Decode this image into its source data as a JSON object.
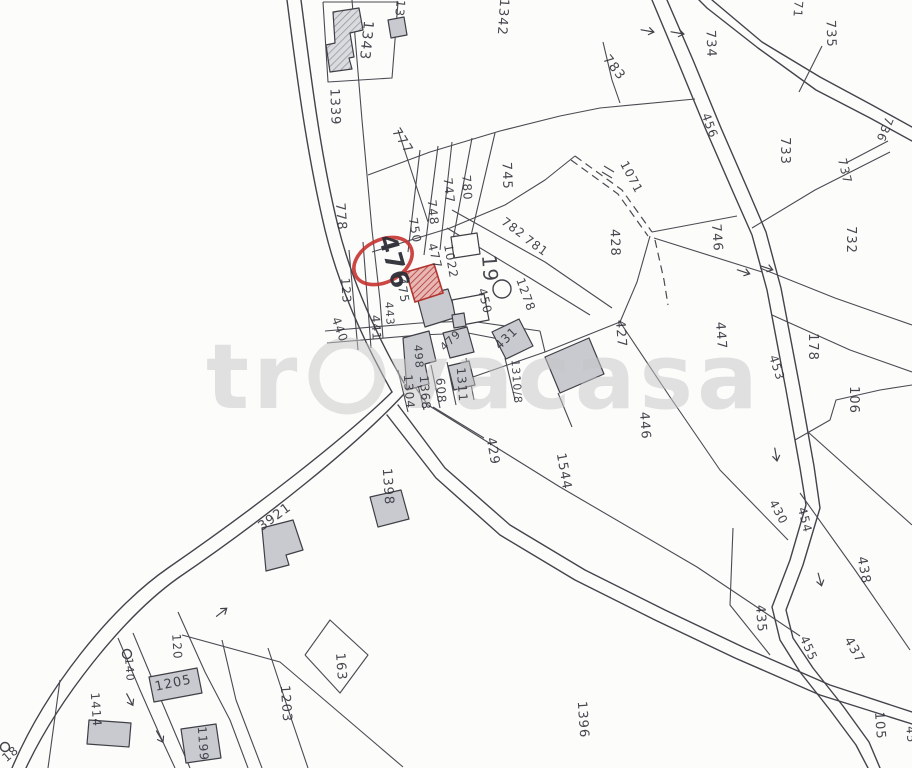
{
  "map": {
    "watermark": {
      "prefix": "tr",
      "suffix": "vacasa",
      "full": "trovacasa",
      "color": "#c6c6c6"
    },
    "highlight": {
      "parcel": "476",
      "ellipse_color": "#c63230",
      "building_fill": "#c0504d"
    },
    "colors": {
      "line": "#43434b",
      "building_fill": "#c8cad0",
      "background": "#fcfcfb",
      "label": "#2e2f37",
      "highlight_red": "#c63230"
    },
    "labels": [
      {
        "text": "1343",
        "x": 362,
        "y": 40,
        "rot": 96,
        "size": 14
      },
      {
        "text": "13",
        "x": 396,
        "y": 8,
        "rot": 96,
        "size": 12
      },
      {
        "text": "1342",
        "x": 499,
        "y": 17,
        "rot": 94,
        "size": 13
      },
      {
        "text": "1339",
        "x": 331,
        "y": 107,
        "rot": 88,
        "size": 13
      },
      {
        "text": "777",
        "x": 399,
        "y": 143,
        "rot": 58,
        "size": 13
      },
      {
        "text": "783",
        "x": 611,
        "y": 70,
        "rot": 52,
        "size": 13
      },
      {
        "text": "71",
        "x": 794,
        "y": 9,
        "rot": 94,
        "size": 12
      },
      {
        "text": "734",
        "x": 707,
        "y": 44,
        "rot": 88,
        "size": 13
      },
      {
        "text": "735",
        "x": 827,
        "y": 34,
        "rot": 88,
        "size": 13
      },
      {
        "text": "736",
        "x": 881,
        "y": 128,
        "rot": 112,
        "size": 12
      },
      {
        "text": "733",
        "x": 781,
        "y": 151,
        "rot": 90,
        "size": 13
      },
      {
        "text": "737",
        "x": 841,
        "y": 172,
        "rot": 76,
        "size": 12
      },
      {
        "text": "732",
        "x": 847,
        "y": 240,
        "rot": 90,
        "size": 13
      },
      {
        "text": "456",
        "x": 706,
        "y": 127,
        "rot": 70,
        "size": 12
      },
      {
        "text": "1071",
        "x": 628,
        "y": 179,
        "rot": 62,
        "size": 12
      },
      {
        "text": "428",
        "x": 611,
        "y": 243,
        "rot": 88,
        "size": 13
      },
      {
        "text": "746",
        "x": 713,
        "y": 238,
        "rot": 86,
        "size": 13
      },
      {
        "text": "745",
        "x": 503,
        "y": 176,
        "rot": 88,
        "size": 13
      },
      {
        "text": "780",
        "x": 463,
        "y": 188,
        "rot": 86,
        "size": 12
      },
      {
        "text": "747",
        "x": 445,
        "y": 191,
        "rot": 84,
        "size": 12
      },
      {
        "text": "748",
        "x": 429,
        "y": 213,
        "rot": 84,
        "size": 12
      },
      {
        "text": "750",
        "x": 411,
        "y": 231,
        "rot": 80,
        "size": 12
      },
      {
        "text": "778",
        "x": 337,
        "y": 217,
        "rot": 86,
        "size": 13
      },
      {
        "text": "782",
        "x": 511,
        "y": 231,
        "rot": 36,
        "size": 12
      },
      {
        "text": "781",
        "x": 534,
        "y": 249,
        "rot": 36,
        "size": 12
      },
      {
        "text": "123",
        "x": 342,
        "y": 291,
        "rot": 86,
        "size": 12
      },
      {
        "text": "440",
        "x": 336,
        "y": 331,
        "rot": 70,
        "size": 12
      },
      {
        "text": "441",
        "x": 372,
        "y": 328,
        "rot": 86,
        "size": 12
      },
      {
        "text": "443",
        "x": 386,
        "y": 314,
        "rot": 86,
        "size": 11
      },
      {
        "text": "475",
        "x": 399,
        "y": 291,
        "rot": 80,
        "size": 12
      },
      {
        "text": "477",
        "x": 431,
        "y": 257,
        "rot": 76,
        "size": 12
      },
      {
        "text": "1022",
        "x": 447,
        "y": 262,
        "rot": 80,
        "size": 12
      },
      {
        "text": "476",
        "x": 386,
        "y": 264,
        "rot": 74,
        "size": 25,
        "emph": true
      },
      {
        "text": "19",
        "x": 483,
        "y": 269,
        "rot": 86,
        "size": 20
      },
      {
        "text": "450",
        "x": 481,
        "y": 302,
        "rot": 76,
        "size": 12
      },
      {
        "text": "1278",
        "x": 522,
        "y": 296,
        "rot": 70,
        "size": 12
      },
      {
        "text": "431",
        "x": 509,
        "y": 341,
        "rot": -44,
        "size": 12
      },
      {
        "text": "479",
        "x": 453,
        "y": 343,
        "rot": -44,
        "size": 11
      },
      {
        "text": "498",
        "x": 415,
        "y": 357,
        "rot": 86,
        "size": 11
      },
      {
        "text": "1310/8",
        "x": 513,
        "y": 382,
        "rot": 86,
        "size": 11
      },
      {
        "text": "1304",
        "x": 405,
        "y": 392,
        "rot": 86,
        "size": 12
      },
      {
        "text": "1368",
        "x": 421,
        "y": 393,
        "rot": 86,
        "size": 12
      },
      {
        "text": "608",
        "x": 437,
        "y": 391,
        "rot": 86,
        "size": 12
      },
      {
        "text": "1311",
        "x": 458,
        "y": 385,
        "rot": 86,
        "size": 12
      },
      {
        "text": "429",
        "x": 489,
        "y": 452,
        "rot": 80,
        "size": 13
      },
      {
        "text": "1544",
        "x": 560,
        "y": 472,
        "rot": 80,
        "size": 13
      },
      {
        "text": "446",
        "x": 641,
        "y": 426,
        "rot": 86,
        "size": 13
      },
      {
        "text": "427",
        "x": 617,
        "y": 334,
        "rot": 86,
        "size": 13
      },
      {
        "text": "447",
        "x": 717,
        "y": 336,
        "rot": 86,
        "size": 13
      },
      {
        "text": "453",
        "x": 773,
        "y": 369,
        "rot": 72,
        "size": 12
      },
      {
        "text": "178",
        "x": 809,
        "y": 347,
        "rot": 90,
        "size": 13
      },
      {
        "text": "106",
        "x": 850,
        "y": 400,
        "rot": 90,
        "size": 13
      },
      {
        "text": "430",
        "x": 775,
        "y": 514,
        "rot": 62,
        "size": 12
      },
      {
        "text": "454",
        "x": 801,
        "y": 521,
        "rot": 76,
        "size": 12
      },
      {
        "text": "438",
        "x": 860,
        "y": 571,
        "rot": 80,
        "size": 13
      },
      {
        "text": "435",
        "x": 757,
        "y": 619,
        "rot": 86,
        "size": 13
      },
      {
        "text": "455",
        "x": 805,
        "y": 650,
        "rot": 66,
        "size": 12
      },
      {
        "text": "437",
        "x": 851,
        "y": 652,
        "rot": 60,
        "size": 13
      },
      {
        "text": "105",
        "x": 876,
        "y": 726,
        "rot": 86,
        "size": 13
      },
      {
        "text": "45",
        "x": 907,
        "y": 735,
        "rot": 86,
        "size": 12
      },
      {
        "text": "1396",
        "x": 579,
        "y": 720,
        "rot": 86,
        "size": 13
      },
      {
        "text": "163",
        "x": 337,
        "y": 667,
        "rot": 86,
        "size": 13
      },
      {
        "text": "3921",
        "x": 277,
        "y": 520,
        "rot": -36,
        "size": 13
      },
      {
        "text": "1398",
        "x": 384,
        "y": 487,
        "rot": 86,
        "size": 13
      },
      {
        "text": "120",
        "x": 173,
        "y": 647,
        "rot": 86,
        "size": 12
      },
      {
        "text": "140",
        "x": 126,
        "y": 670,
        "rot": 86,
        "size": 11
      },
      {
        "text": "1205",
        "x": 174,
        "y": 687,
        "rot": -12,
        "size": 13
      },
      {
        "text": "1203",
        "x": 282,
        "y": 704,
        "rot": 86,
        "size": 13
      },
      {
        "text": "1414",
        "x": 92,
        "y": 710,
        "rot": 86,
        "size": 12
      },
      {
        "text": "1199",
        "x": 199,
        "y": 744,
        "rot": 86,
        "size": 12
      },
      {
        "text": "18",
        "x": 13,
        "y": 757,
        "rot": -40,
        "size": 12
      }
    ]
  }
}
